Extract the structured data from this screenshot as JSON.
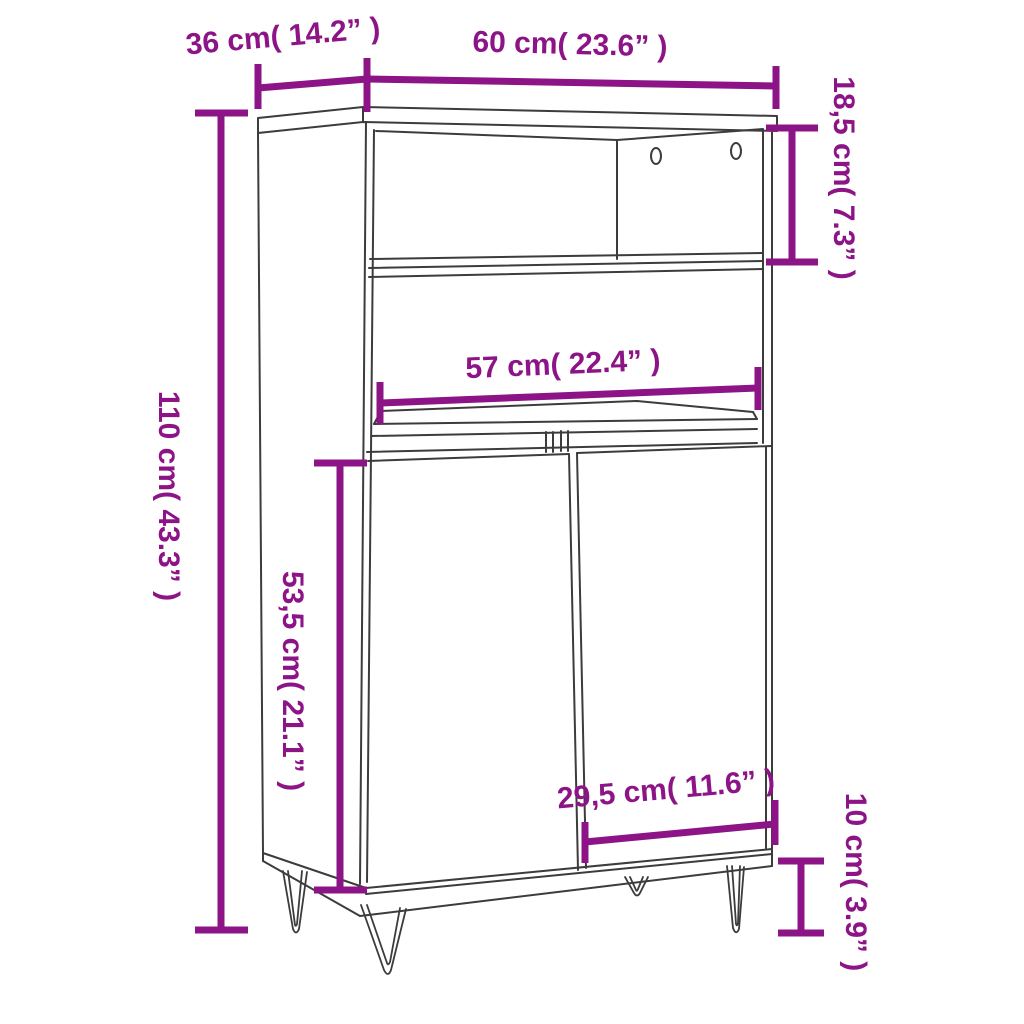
{
  "meta": {
    "subject": "Highboard cabinet dimension diagram (open shelves, two doors, hairpin legs)",
    "background_color": "#ffffff",
    "accent_color": "#8c1487",
    "line_color": "#3c3c3c"
  },
  "dimensions": {
    "top_depth": {
      "label": "36 cm( 14.2” )",
      "cm": "36",
      "inch": "14.2"
    },
    "top_width": {
      "label": "60 cm( 23.6” )",
      "cm": "60",
      "inch": "23.6"
    },
    "upper_compartment_height": {
      "label": "18,5 cm( 7.3” )",
      "cm": "18,5",
      "inch": "7.3"
    },
    "total_height": {
      "label": "110 cm( 43.3” )",
      "cm": "110",
      "inch": "43.3"
    },
    "inner_width": {
      "label": "57 cm( 22.4” )",
      "cm": "57",
      "inch": "22.4"
    },
    "door_section_height": {
      "label": "53,5 cm( 21.1” )",
      "cm": "53,5",
      "inch": "21.1"
    },
    "door_width": {
      "label": "29,5 cm( 11.6” )",
      "cm": "29,5",
      "inch": "11.6"
    },
    "leg_height": {
      "label": "10 cm( 3.9” )",
      "cm": "10",
      "inch": "3.9"
    }
  }
}
